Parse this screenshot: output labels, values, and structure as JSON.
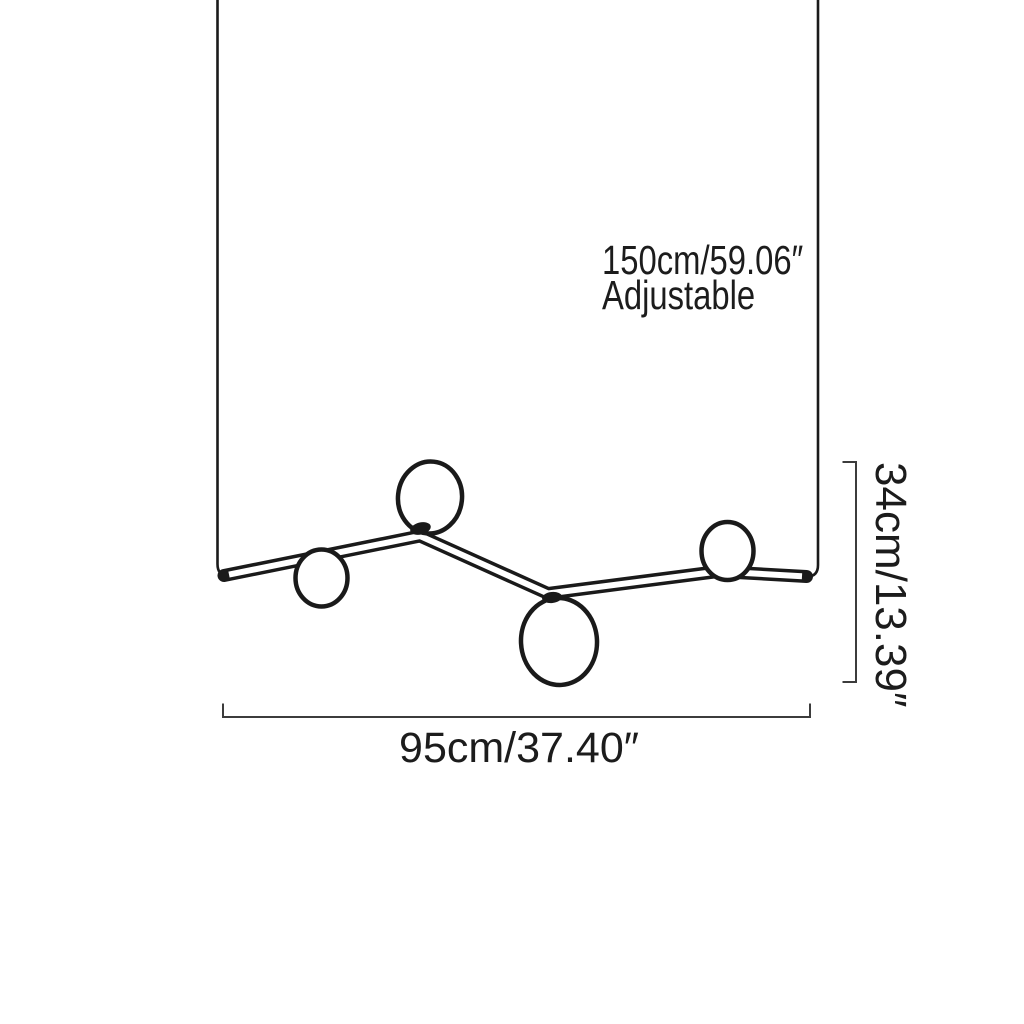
{
  "diagram": {
    "type": "product-dimension-drawing",
    "subject": "zigzag pendant light with four glass globes and two suspension cables",
    "globe_count": 4,
    "colors": {
      "background": "#ffffff",
      "fixture_line": "#1a1a1a",
      "dimension_line": "#3c3c3c",
      "text": "#1c1c1c"
    },
    "annotations": {
      "suspension_line1": "150cm/59.06″",
      "suspension_line2": "Adjustable",
      "fixture_drop": "34cm/13.39″",
      "fixture_width": "95cm/37.40″"
    }
  }
}
